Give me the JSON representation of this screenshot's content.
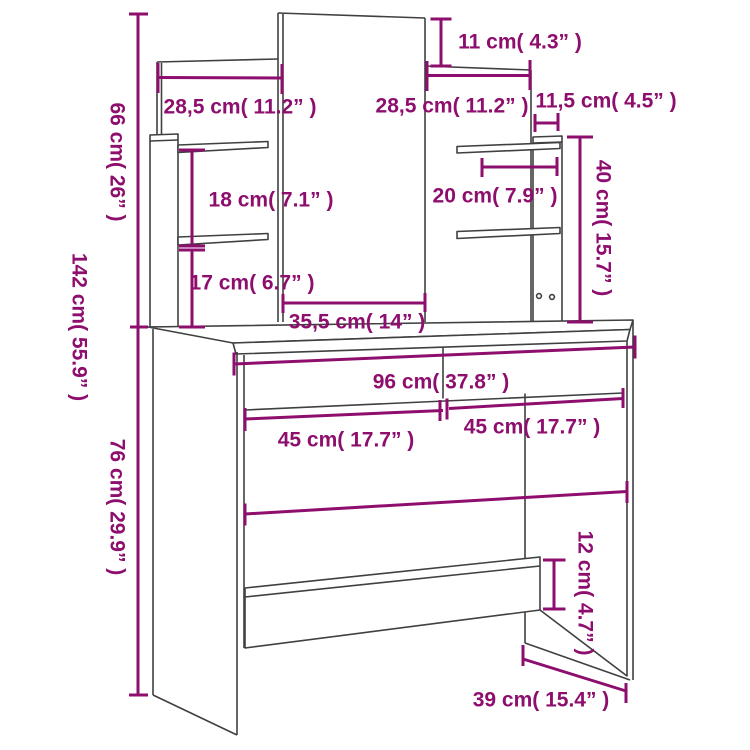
{
  "diagram": {
    "type": "product-dimension-diagram",
    "product": "dressing table with mirror and shelves",
    "background": "#ffffff",
    "line_color": "#3f4040",
    "dimension_color": "#8e0e6e",
    "units": [
      "cm",
      "inch"
    ],
    "labels": [
      {
        "id": "mirror-top-height-11cm",
        "text": "11 cm( 4.3” )",
        "x": 520,
        "y": 42,
        "rot": 0
      },
      {
        "id": "left-panel-width-28-5cm",
        "text": "28,5 cm( 11.2” )",
        "x": 240,
        "y": 107,
        "rot": 0
      },
      {
        "id": "right-panel-width-28-5cm",
        "text": "28,5 cm( 11.2” )",
        "x": 452,
        "y": 106,
        "rot": 0
      },
      {
        "id": "side-strip-depth-11-5cm",
        "text": "11,5 cm( 4.5” )",
        "x": 606,
        "y": 101,
        "rot": 0
      },
      {
        "id": "shelf-gap-18cm",
        "text": "18 cm( 7.1” )",
        "x": 271,
        "y": 200,
        "rot": 0
      },
      {
        "id": "shelf-depth-20cm",
        "text": "20 cm( 7.9” )",
        "x": 495,
        "y": 196,
        "rot": 0
      },
      {
        "id": "shelf-to-top-17cm",
        "text": "17 cm( 6.7” )",
        "x": 252,
        "y": 283,
        "rot": 0
      },
      {
        "id": "mirror-width-35-5cm",
        "text": "35,5 cm( 14” )",
        "x": 357,
        "y": 322,
        "rot": 0
      },
      {
        "id": "table-width-96cm",
        "text": "96 cm( 37.8” )",
        "x": 441,
        "y": 382,
        "rot": 0
      },
      {
        "id": "drawer-left-width-45cm",
        "text": "45 cm( 17.7” )",
        "x": 346,
        "y": 440,
        "rot": 0
      },
      {
        "id": "drawer-right-width-45cm",
        "text": "45 cm( 17.7” )",
        "x": 532,
        "y": 427,
        "rot": 0
      },
      {
        "id": "table-depth-39cm",
        "text": "39 cm( 15.4” )",
        "x": 541,
        "y": 700,
        "rot": 0
      },
      {
        "id": "upper-height-66cm",
        "text": "66 cm( 26” )",
        "x": 117,
        "y": 162,
        "rot": 90
      },
      {
        "id": "total-height-142cm",
        "text": "142 cm( 55.9” )",
        "x": 79,
        "y": 327,
        "rot": 90
      },
      {
        "id": "table-height-76cm",
        "text": "76 cm( 29.9” )",
        "x": 117,
        "y": 507,
        "rot": 90
      },
      {
        "id": "shelf-unit-height-40cm",
        "text": "40 cm( 15.7” )",
        "x": 603,
        "y": 228,
        "rot": 90
      },
      {
        "id": "crossbar-height-12cm",
        "text": "12 cm( 4.7” )",
        "x": 585,
        "y": 593,
        "rot": 90
      }
    ]
  }
}
